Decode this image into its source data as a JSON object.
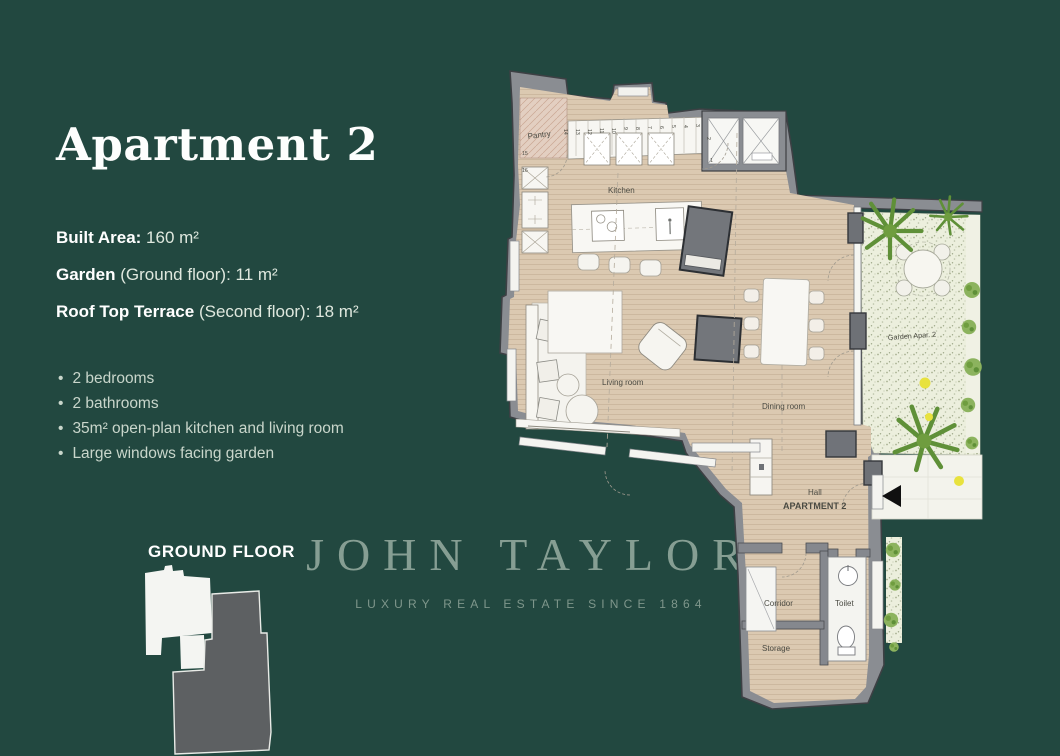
{
  "page": {
    "background": "#224840"
  },
  "header": {
    "title": "Apartment 2"
  },
  "specs": [
    {
      "label": "Built Area:",
      "rest": " 160 m²"
    },
    {
      "label": "Garden",
      "rest": " (Ground floor): 11 m²"
    },
    {
      "label": "Roof Top Terrace",
      "rest": " (Second floor): 18 m²"
    }
  ],
  "features": [
    "2 bedrooms",
    "2 bathrooms",
    "35m² open-plan kitchen and living room",
    "Large windows facing garden"
  ],
  "key_plan": {
    "floor_label": "GROUND FLOOR"
  },
  "watermark": {
    "brand": "JOHN TAYLOR",
    "tagline": "LUXURY REAL ESTATE SINCE 1864"
  },
  "floorplan": {
    "rooms": {
      "pantry": "Pantry",
      "kitchen": "Kitchen",
      "living": "Living room",
      "dining": "Dining room",
      "hall": "Hall",
      "apartment": "APARTMENT 2",
      "corridor": "Corridor",
      "toilet": "Toilet",
      "storage": "Storage",
      "garden": "Garden Apar. 2"
    },
    "unit_numbers": [
      "1",
      "2",
      "3",
      "4",
      "5",
      "6",
      "7",
      "8",
      "9",
      "10",
      "11",
      "12",
      "13",
      "14",
      "15",
      "16"
    ],
    "colors": {
      "floor": "#dbc9b1",
      "wall": "#8a8d92",
      "garden_green": "#6f9d3f",
      "accent_yellow": "#e8e23e"
    }
  }
}
